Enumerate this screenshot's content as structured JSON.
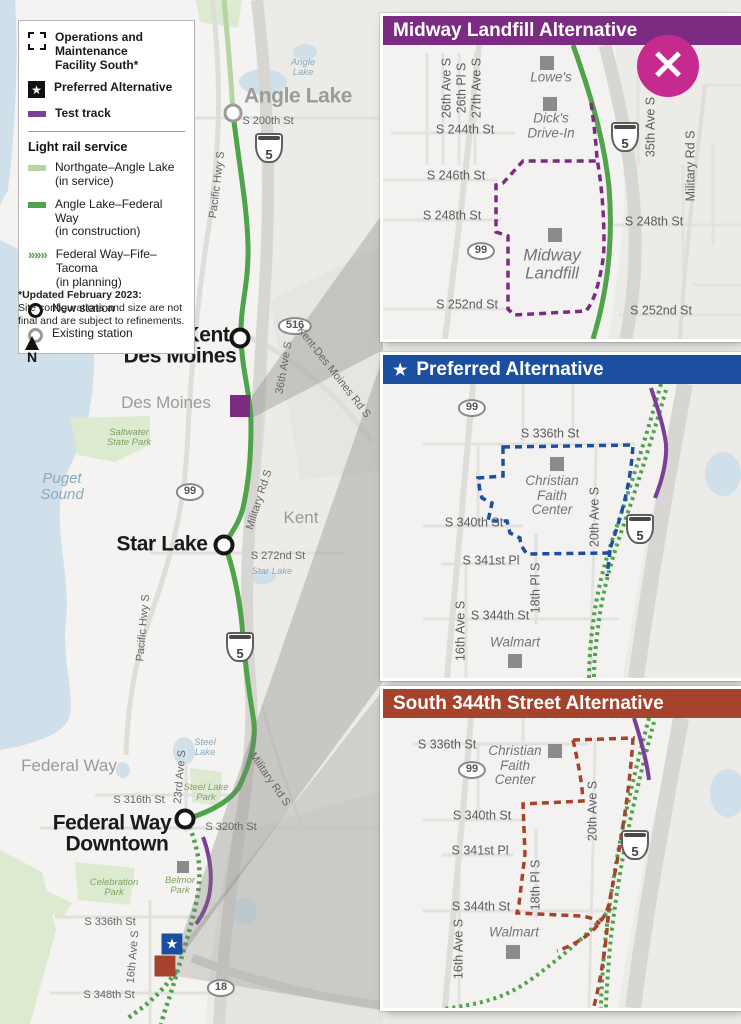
{
  "colors": {
    "purple_header": "#7c2b82",
    "blue_header": "#1d4fa1",
    "brick_header": "#a5432c",
    "magenta_close": "#c52a8e",
    "green_in_construction": "#4fa34a",
    "green_in_service": "#b5d6a2",
    "test_track_purple": "#7a3f98",
    "water": "#cfe0ea",
    "park_green": "#dcead0"
  },
  "close_icon": "×",
  "star_icon": "★",
  "north_label": "N",
  "legend": {
    "omf": "Operations and\nMaintenance\nFacility South*",
    "preferred": "Preferred Alternative",
    "test_track": "Test track",
    "section": "Light rail service",
    "chevron_icon": "»»»",
    "services": [
      {
        "name": "Northgate–Angle Lake",
        "status": "(in service)"
      },
      {
        "name": "Angle Lake–Federal Way",
        "status": "(in construction)"
      },
      {
        "name": "Federal Way–Fife–Tacoma",
        "status": "(in planning)"
      }
    ],
    "new_station": "New station",
    "existing_station": "Existing station"
  },
  "note": {
    "title": "*Updated February 2023:",
    "body": "Site configurations and size are not\nfinal and are subject to refinements."
  },
  "panels": [
    {
      "title": "Midway Landfill Alternative"
    },
    {
      "title": "Preferred Alternative"
    },
    {
      "title": "South 344th Street Alternative"
    }
  ],
  "main_map": {
    "labels": [
      {
        "t": "Angle Lake",
        "x": 298,
        "y": 97,
        "c": "stn gray",
        "n": "station-label-angle-lake"
      },
      {
        "t": "S 200th St",
        "x": 268,
        "y": 122,
        "c": "st",
        "n": "street-label-s-200th-st"
      },
      {
        "t": "Angle\nLake",
        "x": 303,
        "y": 68,
        "c": "wat wat-sm",
        "n": "lake-label-angle-lake"
      },
      {
        "t": "Pacific Hwy S",
        "x": 218,
        "y": 185,
        "r": -83,
        "c": "st",
        "n": "street-label-pacific-hwy-s"
      },
      {
        "t": "5",
        "x": 269,
        "y": 148,
        "c": "i5",
        "n": "i5-shield"
      },
      {
        "t": "Kent",
        "x": 207,
        "y": 336,
        "c": "stn",
        "n": "station-label-kent"
      },
      {
        "t": "Des Moines",
        "x": 180,
        "y": 357,
        "c": "stn",
        "n": "station-label-des-moines"
      },
      {
        "t": "516",
        "x": 295,
        "y": 326,
        "c": "sr",
        "n": "sr516-shield"
      },
      {
        "t": "36th Ave S",
        "x": 285,
        "y": 368,
        "r": -80,
        "c": "st",
        "n": "street-label-36th-ave-s"
      },
      {
        "t": "Kent-Des Moines Rd S",
        "x": 333,
        "y": 373,
        "r": 52,
        "c": "st",
        "n": "street-label-kent-des-moines-rd-s"
      },
      {
        "t": "Des Moines",
        "x": 166,
        "y": 403,
        "c": "city",
        "n": "city-label-des-moines"
      },
      {
        "t": "Saltwater\nState Park",
        "x": 129,
        "y": 438,
        "c": "park",
        "n": "park-label-saltwater-state-park"
      },
      {
        "t": "Puget\nSound",
        "x": 62,
        "y": 487,
        "c": "wat",
        "n": "water-label-puget-sound"
      },
      {
        "t": "99",
        "x": 190,
        "y": 492,
        "c": "sr",
        "n": "sr99-shield"
      },
      {
        "t": "Military Rd S",
        "x": 260,
        "y": 500,
        "r": -72,
        "c": "st",
        "n": "street-label-military-rd-s"
      },
      {
        "t": "Kent",
        "x": 301,
        "y": 518,
        "c": "city",
        "n": "city-label-kent"
      },
      {
        "t": "Star Lake",
        "x": 162,
        "y": 545,
        "c": "stn",
        "n": "station-label-star-lake"
      },
      {
        "t": "S 272nd St",
        "x": 278,
        "y": 557,
        "c": "st",
        "n": "street-label-s-272nd-st"
      },
      {
        "t": "Star Lake",
        "x": 272,
        "y": 572,
        "c": "wat wat-sm",
        "n": "lake-label-star-lake"
      },
      {
        "t": "Pacific Hwy S",
        "x": 144,
        "y": 628,
        "r": -85,
        "c": "st",
        "n": "street-label-pacific-hwy-s"
      },
      {
        "t": "5",
        "x": 240,
        "y": 647,
        "c": "i5",
        "n": "i5-shield"
      },
      {
        "t": "Federal Way",
        "x": 69,
        "y": 766,
        "c": "city",
        "n": "city-label-federal-way"
      },
      {
        "t": "Steel\nLake",
        "x": 205,
        "y": 748,
        "c": "wat wat-sm",
        "n": "lake-label-steel-lake"
      },
      {
        "t": "23rd Ave S",
        "x": 181,
        "y": 777,
        "r": -85,
        "c": "st",
        "n": "street-label-23rd-ave-s"
      },
      {
        "t": "Steel Lake\nPark",
        "x": 206,
        "y": 793,
        "c": "park",
        "n": "park-label-steel-lake-park"
      },
      {
        "t": "Military Rd S",
        "x": 269,
        "y": 780,
        "r": 55,
        "c": "st",
        "n": "street-label-military-rd-s"
      },
      {
        "t": "S 316th St",
        "x": 139,
        "y": 801,
        "c": "st",
        "n": "street-label-s-316th-st"
      },
      {
        "t": "Federal Way",
        "x": 112,
        "y": 824,
        "c": "stn",
        "n": "station-label-federal-way"
      },
      {
        "t": "Downtown",
        "x": 117,
        "y": 845,
        "c": "stn",
        "n": "station-label-downtown"
      },
      {
        "t": "S 320th St",
        "x": 231,
        "y": 828,
        "c": "st",
        "n": "street-label-s-320th-st"
      },
      {
        "t": "Celebration\nPark",
        "x": 114,
        "y": 888,
        "c": "park",
        "n": "park-label-celebration-park"
      },
      {
        "t": "Belmor\nPark",
        "x": 180,
        "y": 886,
        "c": "park",
        "n": "park-label-belmor-park"
      },
      {
        "t": "S 336th St",
        "x": 110,
        "y": 923,
        "c": "st",
        "n": "street-label-s-336th-st"
      },
      {
        "t": "16th Ave S",
        "x": 134,
        "y": 957,
        "r": -85,
        "c": "st",
        "n": "street-label-16th-ave-s"
      },
      {
        "t": "S 348th St",
        "x": 109,
        "y": 996,
        "c": "st",
        "n": "street-label-s-348th-st"
      },
      {
        "t": "18",
        "x": 221,
        "y": 988,
        "c": "sr",
        "n": "sr18-shield"
      },
      {
        "x": 233,
        "y": 113,
        "c": "st-old",
        "n": "existing-station-marker-angle-lake"
      },
      {
        "x": 240,
        "y": 338,
        "c": "st-new",
        "n": "new-station-marker-kent-des-moines"
      },
      {
        "x": 224,
        "y": 545,
        "c": "st-new",
        "n": "new-station-marker-star-lake"
      },
      {
        "x": 185,
        "y": 819,
        "c": "st-new",
        "n": "new-station-marker-federal-way-downtown"
      },
      {
        "x": 240,
        "y": 406,
        "c": "sq-purple",
        "n": "midway-landfill-site-marker"
      },
      {
        "x": 183,
        "y": 867,
        "c": "sq-gray sm",
        "n": "belmor-park-building-marker"
      },
      {
        "t": "★",
        "x": 172,
        "y": 944,
        "c": "sq-star",
        "n": "preferred-site-marker"
      },
      {
        "x": 165,
        "y": 966,
        "c": "sq-brown",
        "n": "s344-site-marker"
      }
    ]
  },
  "panel_midway": {
    "labels": [
      {
        "t": "26th Ave S",
        "x": 64,
        "y": 43,
        "r": -90,
        "c": "st2",
        "n": "street-label-26th-ave-s"
      },
      {
        "t": "26th Pl S",
        "x": 79,
        "y": 43,
        "r": -90,
        "c": "st2",
        "n": "street-label-26th-pl-s"
      },
      {
        "t": "27th Ave S",
        "x": 94,
        "y": 43,
        "r": -90,
        "c": "st2",
        "n": "street-label-27th-ave-s"
      },
      {
        "t": "S 244th St",
        "x": 82,
        "y": 85,
        "c": "st2",
        "n": "street-label-s-244th-st"
      },
      {
        "x": 164,
        "y": 18,
        "c": "sq-gray",
        "n": "lowes-building-marker"
      },
      {
        "t": "Lowe's",
        "x": 168,
        "y": 33,
        "c": "lm",
        "n": "landmark-label-lowes"
      },
      {
        "x": 167,
        "y": 59,
        "c": "sq-gray",
        "n": "dicks-drive-in-building-marker"
      },
      {
        "t": "Dick's\nDrive-In",
        "x": 168,
        "y": 81,
        "c": "lm",
        "n": "landmark-label-dicks-drive-in"
      },
      {
        "t": "S 246th St",
        "x": 73,
        "y": 131,
        "c": "st2",
        "n": "street-label-s-246th-st"
      },
      {
        "t": "S 248th St",
        "x": 69,
        "y": 171,
        "c": "st2",
        "n": "street-label-s-248th-st"
      },
      {
        "t": "S 248th St",
        "x": 271,
        "y": 177,
        "c": "st2",
        "n": "street-label-s-248th-st"
      },
      {
        "t": "99",
        "x": 98,
        "y": 206,
        "c": "sr",
        "n": "sr99-shield"
      },
      {
        "x": 172,
        "y": 190,
        "c": "sq-gray",
        "n": "midway-landfill-building-marker"
      },
      {
        "t": "Midway\nLandfill",
        "x": 169,
        "y": 220,
        "c": "lm lm-lg",
        "n": "landmark-label-midway-landfill"
      },
      {
        "t": "S 252nd St",
        "x": 84,
        "y": 260,
        "c": "st2",
        "n": "street-label-s-252nd-st"
      },
      {
        "t": "S 252nd St",
        "x": 278,
        "y": 266,
        "c": "st2",
        "n": "street-label-s-252nd-st"
      },
      {
        "t": "Military Rd S",
        "x": 308,
        "y": 121,
        "r": -90,
        "c": "st2",
        "n": "street-label-military-rd-s"
      },
      {
        "t": "35th Ave S",
        "x": 268,
        "y": 82,
        "r": -90,
        "c": "st2",
        "n": "street-label-35th-ave-s"
      },
      {
        "t": "5",
        "x": 242,
        "y": 92,
        "c": "i5",
        "n": "i5-shield"
      }
    ]
  },
  "panel_preferred": {
    "labels": [
      {
        "t": "99",
        "x": 89,
        "y": 24,
        "c": "sr",
        "n": "sr99-shield"
      },
      {
        "t": "S 336th St",
        "x": 167,
        "y": 50,
        "c": "st2",
        "n": "street-label-s-336th-st"
      },
      {
        "x": 174,
        "y": 80,
        "c": "sq-gray",
        "n": "christian-faith-center-building-marker"
      },
      {
        "t": "Christian\nFaith\nCenter",
        "x": 169,
        "y": 112,
        "c": "lm",
        "n": "landmark-label-christian-faith-center"
      },
      {
        "t": "20th Ave S",
        "x": 212,
        "y": 133,
        "r": -90,
        "c": "st2",
        "n": "street-label-20th-ave-s"
      },
      {
        "t": "S 340th St",
        "x": 91,
        "y": 139,
        "c": "st2",
        "n": "street-label-s-340th-st"
      },
      {
        "t": "S 341st Pl",
        "x": 108,
        "y": 177,
        "c": "st2",
        "n": "street-label-s-341st-pl"
      },
      {
        "t": "18th Pl S",
        "x": 153,
        "y": 204,
        "r": -90,
        "c": "st2",
        "n": "street-label-18th-pl-s"
      },
      {
        "t": "S 344th St",
        "x": 117,
        "y": 232,
        "c": "st2",
        "n": "street-label-s-344th-st"
      },
      {
        "t": "16th Ave S",
        "x": 78,
        "y": 247,
        "r": -90,
        "c": "st2",
        "n": "street-label-16th-ave-s"
      },
      {
        "t": "Walmart",
        "x": 132,
        "y": 259,
        "c": "lm",
        "n": "landmark-label-walmart"
      },
      {
        "x": 132,
        "y": 277,
        "c": "sq-gray",
        "n": "walmart-building-marker"
      },
      {
        "t": "5",
        "x": 257,
        "y": 145,
        "c": "i5",
        "n": "i5-shield"
      }
    ]
  },
  "panel_s344": {
    "labels": [
      {
        "t": "S 336th St",
        "x": 64,
        "y": 27,
        "c": "st2",
        "n": "street-label-s-336th-st"
      },
      {
        "x": 172,
        "y": 33,
        "c": "sq-gray",
        "n": "christian-faith-center-building-marker"
      },
      {
        "t": "Christian\nFaith\nCenter",
        "x": 132,
        "y": 48,
        "c": "lm",
        "n": "landmark-label-christian-faith-center"
      },
      {
        "t": "99",
        "x": 89,
        "y": 52,
        "c": "sr",
        "n": "sr99-shield"
      },
      {
        "t": "S 340th St",
        "x": 99,
        "y": 98,
        "c": "st2",
        "n": "street-label-s-340th-st"
      },
      {
        "t": "20th Ave S",
        "x": 210,
        "y": 93,
        "r": -90,
        "c": "st2",
        "n": "street-label-20th-ave-s"
      },
      {
        "t": "S 341st Pl",
        "x": 97,
        "y": 133,
        "c": "st2",
        "n": "street-label-s-341st-pl"
      },
      {
        "t": "5",
        "x": 252,
        "y": 127,
        "c": "i5",
        "n": "i5-shield"
      },
      {
        "t": "18th Pl S",
        "x": 153,
        "y": 167,
        "r": -90,
        "c": "st2",
        "n": "street-label-18th-pl-s"
      },
      {
        "t": "S 344th St",
        "x": 98,
        "y": 189,
        "c": "st2",
        "n": "street-label-s-344th-st"
      },
      {
        "t": "16th Ave S",
        "x": 76,
        "y": 231,
        "r": -90,
        "c": "st2",
        "n": "street-label-16th-ave-s"
      },
      {
        "t": "Walmart",
        "x": 131,
        "y": 215,
        "c": "lm",
        "n": "landmark-label-walmart"
      },
      {
        "x": 130,
        "y": 234,
        "c": "sq-gray",
        "n": "walmart-building-marker"
      }
    ]
  }
}
